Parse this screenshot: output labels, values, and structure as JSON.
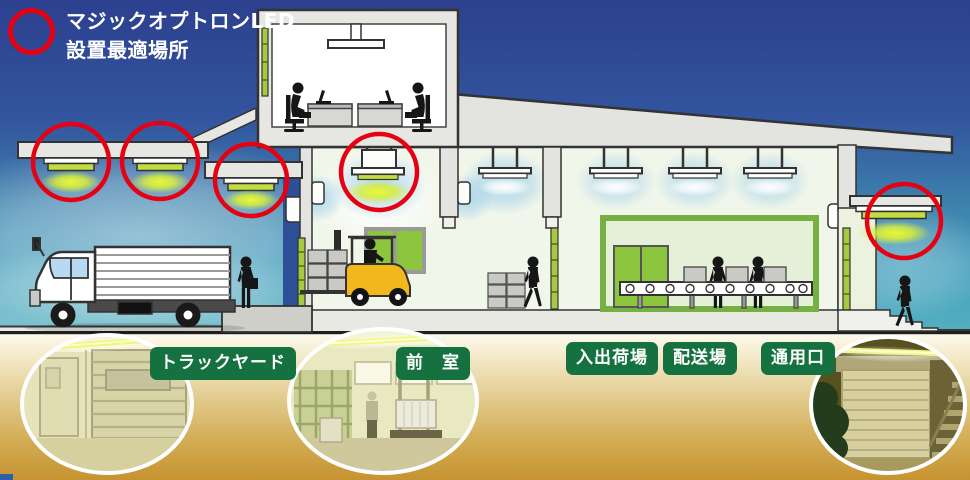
{
  "legend": {
    "line1": "マジックオプトロンLED",
    "line2": "設置最適場所"
  },
  "areas": [
    {
      "label": "トラックヤード"
    },
    {
      "label": "前　室"
    },
    {
      "label": "入出荷場"
    },
    {
      "label": "配送場"
    },
    {
      "label": "通用口"
    }
  ],
  "colors": {
    "marker_red": "#e60012",
    "label_green": "#15713f",
    "led_green": "#c3dc40",
    "sky_top": "#2c408e",
    "ground_gold": "#c69330"
  },
  "icons": {
    "marker": "red-circle-marker",
    "lamp": "led-ceiling-lamp"
  }
}
